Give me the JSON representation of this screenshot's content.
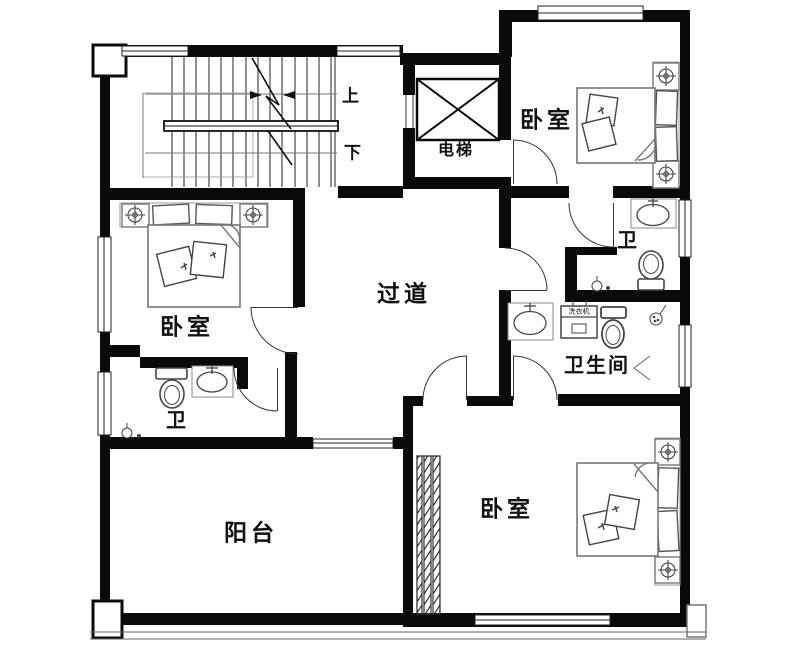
{
  "rooms": {
    "bedroom_left": "卧室",
    "bedroom_top_right": "卧室",
    "bedroom_bottom": "卧室",
    "corridor": "过道",
    "bathroom": "卫生间",
    "toilet_top_right": "卫",
    "toilet_left": "卫",
    "balcony": "阳台"
  },
  "labels": {
    "elevator": "电梯",
    "stairs_up": "上",
    "stairs_down": "下",
    "washing_machine": "洗衣机"
  },
  "colors": {
    "wall": "#0a0a0a",
    "fixture": "#555555",
    "text": "#111111",
    "background": "#ffffff"
  }
}
